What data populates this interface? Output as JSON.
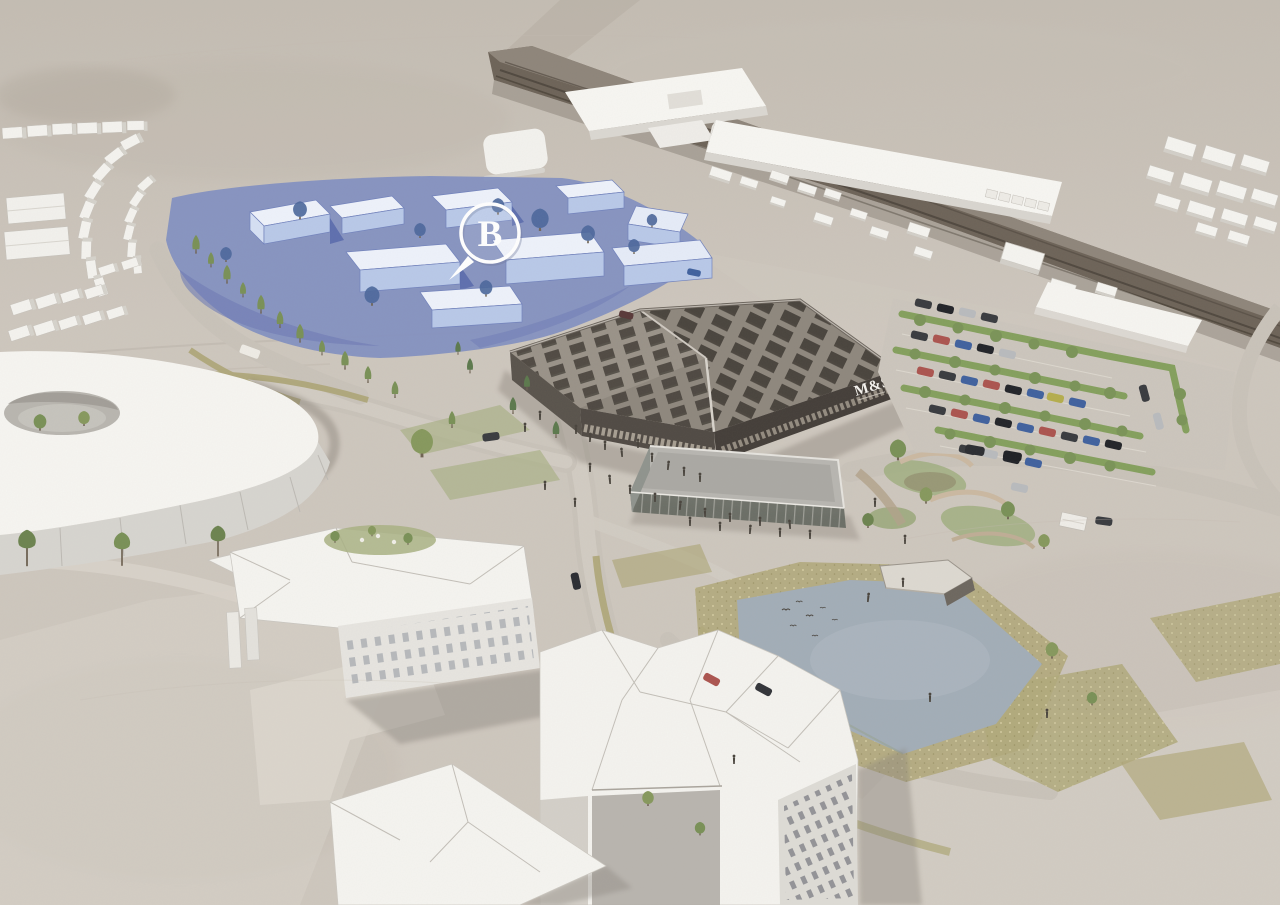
{
  "scene": {
    "description": "aerial-watercolour-masterplan-visualisation",
    "marker": {
      "label": "B"
    },
    "store": {
      "sign": "M&S"
    },
    "palette": {
      "paper": "#cec7be",
      "haze": "#c5beb5",
      "path_light": "#d9d3ca",
      "road": "#c9c3ba",
      "railway_dark": "#5f574d",
      "white_roof": "#f5f4f0",
      "white_wall": "#e3e1db",
      "shadow": "#8d8780",
      "zone_blue_ground": "#8290c1",
      "zone_blue_deep": "#5565a8",
      "zone_blue_wall": "#bfcdec",
      "zone_blue_top": "#e9eef9",
      "zone_blue_tree": "#4c689c",
      "store_roof": "#8f887e",
      "store_panel": "#413b35",
      "store_facade": "#544e48",
      "pavilion_roof": "#b8b6b1",
      "pond": "#a3aeb8",
      "meadow": "#b1a97c",
      "grass": "#a8b184",
      "hedge": "#85a05e",
      "tree_green": "#7a9158",
      "car_dark": "#3a3c40",
      "car_red": "#ac5550",
      "car_blue": "#41629f",
      "car_silver": "#b9bbbe",
      "car_yellow": "#b5ae4e",
      "marker_white": "#ffffff"
    }
  }
}
